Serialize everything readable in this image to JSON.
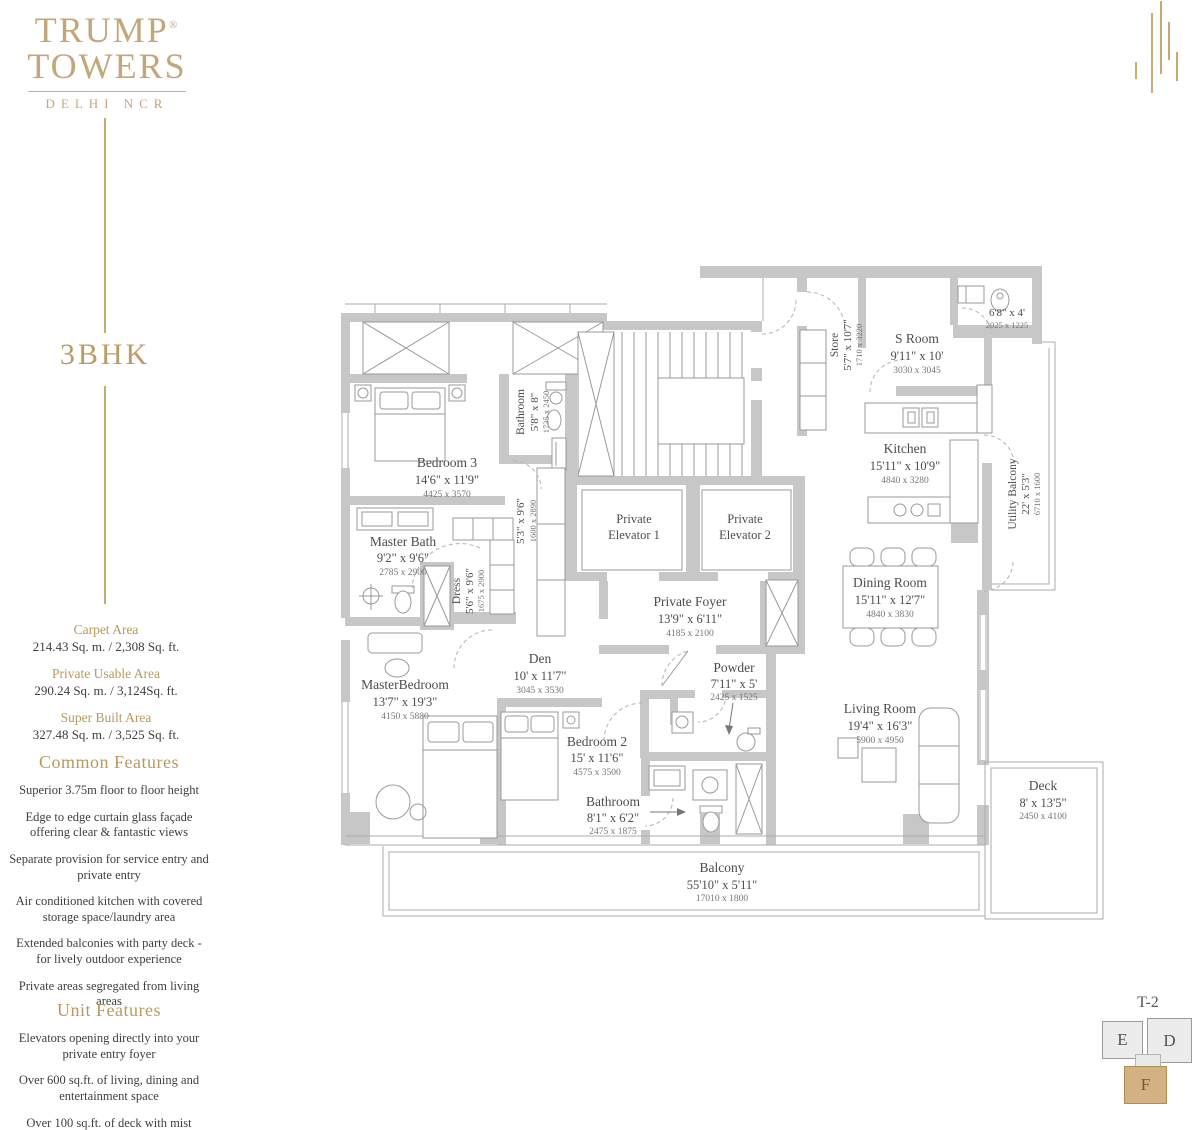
{
  "brand": {
    "line1": "TRUMP",
    "reg": "®",
    "line2": "TOWERS",
    "tagline": "DELHI NCR"
  },
  "unit_type": "3BHK",
  "areas": [
    {
      "label": "Carpet Area",
      "value": "214.43 Sq. m. / 2,308 Sq. ft."
    },
    {
      "label": "Private Usable Area",
      "value": "290.24 Sq. m. / 3,124Sq. ft."
    },
    {
      "label": "Super Built Area",
      "value": "327.48 Sq. m. / 3,525 Sq. ft."
    }
  ],
  "features": {
    "common": {
      "title": "Common Features",
      "items": [
        "Superior 3.75m floor to floor height",
        "Edge to edge curtain glass façade offering clear & fantastic views",
        "Separate provision for service entry and private entry",
        "Air conditioned kitchen with covered storage space/laundry area",
        "Extended balconies with party deck - for lively outdoor experience",
        "Private areas segregated from living areas"
      ]
    },
    "unit": {
      "title": "Unit Features",
      "items": [
        "Elevators opening directly into your private entry foyer",
        "Over 600 sq.ft. of living, dining and entertainment space",
        "Over 100 sq.ft. of deck with mist cooling"
      ]
    }
  },
  "key_plan": {
    "title": "T-2",
    "units": [
      "E",
      "D",
      "F"
    ],
    "highlight": "F"
  },
  "colors": {
    "accent_gold": "#b9995c",
    "wall_gray": "#c7c7c7",
    "keyplan_highlight": "#d4b183"
  },
  "rooms": {
    "bedroom3": {
      "name": "Bedroom 3",
      "dim": "14'6\" x 11'9\"",
      "metric": "4425 x 3570"
    },
    "bathroom3": {
      "name": "Bathroom",
      "dim": "5'8\" x 8\"",
      "metric": "1735 x 2450"
    },
    "passage": {
      "dim": "5'3\" x 9'6\"",
      "metric": "1600 x 2890"
    },
    "master_bath": {
      "name": "Master Bath",
      "dim": "9'2\" x 9'6\"",
      "metric": "2785 x 2900"
    },
    "dress": {
      "name": "Dress",
      "dim": "5'6\" x 9'6\"",
      "metric": "1675 x 2900"
    },
    "master_bedroom": {
      "name": "MasterBedroom",
      "dim": "13'7\" x 19'3\"",
      "metric": "4150 x 5880"
    },
    "den": {
      "name": "Den",
      "dim": "10' x 11'7\"",
      "metric": "3045 x 3530"
    },
    "elevator1": {
      "line1": "Private",
      "line2": "Elevator 1"
    },
    "elevator2": {
      "line1": "Private",
      "line2": "Elevator 2"
    },
    "foyer": {
      "name": "Private Foyer",
      "dim": "13'9\" x 6'11\"",
      "metric": "4185 x 2100"
    },
    "powder": {
      "name": "Powder",
      "dim": "7'11\" x 5'",
      "metric": "2425 x 1525"
    },
    "bedroom2": {
      "name": "Bedroom 2",
      "dim": "15' x 11'6\"",
      "metric": "4575 x 3500"
    },
    "bathroom2": {
      "name": "Bathroom",
      "dim": "8'1\" x 6'2\"",
      "metric": "2475 x 1875"
    },
    "store": {
      "name": "Store",
      "dim": "5'7\" x 10'7\"",
      "metric": "1710 x 3220"
    },
    "s_room": {
      "name": "S Room",
      "dim": "9'11\" x 10'",
      "metric": "3030 x 3045"
    },
    "toilet": {
      "dim": "6'8\" x 4'",
      "metric": "2025 x 1225"
    },
    "kitchen": {
      "name": "Kitchen",
      "dim": "15'11\" x 10'9\"",
      "metric": "4840 x 3280"
    },
    "utility_balcony": {
      "name": "Utility Balcony",
      "dim": "22' x 5'3\"",
      "metric": "6710 x 1600"
    },
    "dining": {
      "name": "Dining Room",
      "dim": "15'11\" x 12'7\"",
      "metric": "4840 x 3830"
    },
    "living": {
      "name": "Living Room",
      "dim": "19'4\" x 16'3\"",
      "metric": "5900 x 4950"
    },
    "deck": {
      "name": "Deck",
      "dim": "8' x 13'5\"",
      "metric": "2450 x 4100"
    },
    "balcony": {
      "name": "Balcony",
      "dim": "55'10\" x 5'11\"",
      "metric": "17010 x 1800"
    }
  }
}
